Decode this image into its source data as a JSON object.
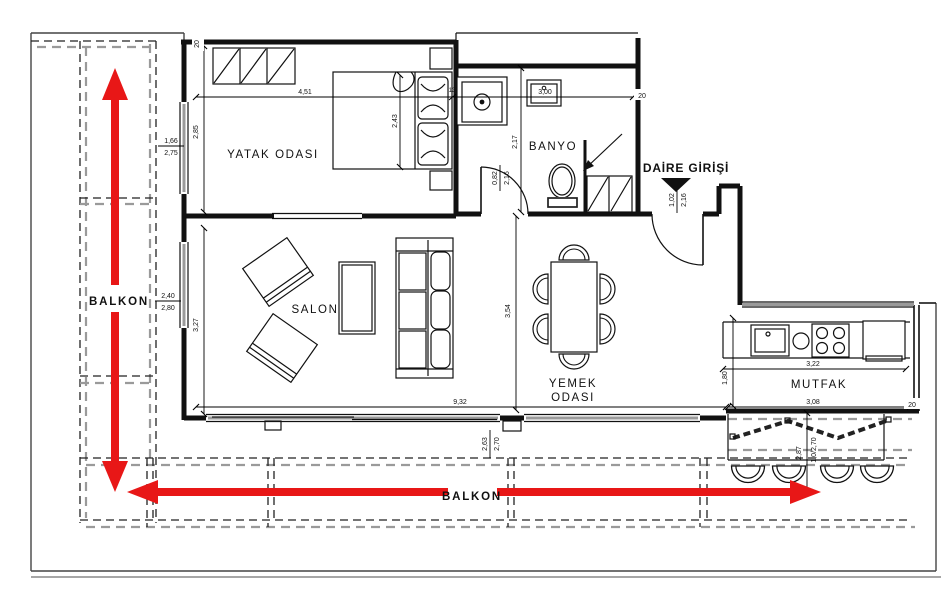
{
  "rooms": {
    "bedroom": "YATAK ODASI",
    "bathroom": "BANYO",
    "salon": "SALON",
    "dining_line1": "YEMEK",
    "dining_line2": "ODASI",
    "kitchen": "MUTFAK",
    "balcony_left": "BALKON",
    "balcony_bottom": "BALKON",
    "entrance": "DAİRE GİRİŞİ"
  },
  "dims": {
    "bedroom_width": "4,51",
    "wall13": "13",
    "bath_width": "3,00",
    "wall20_top": "20",
    "wall20_bath": "20",
    "wall20_kitchen": "20",
    "bed_depth": "2,43",
    "bedroom_height": "2,85",
    "bedroom_window_w": "1,66",
    "bedroom_window_h": "2,75",
    "salon_window_w": "2,40",
    "salon_window_h": "2,80",
    "salon_height": "3,27",
    "bottom_width": "9,32",
    "slider_w": "2,63",
    "slider_h": "2,70",
    "bath_height": "2,17",
    "bath_door_w": "0,82",
    "bath_door_h": "2,16",
    "entry_door_w": "1,02",
    "entry_door_h": "2,16",
    "dining_height": "3,54",
    "kitchen_opening": "1,80",
    "counter_width": "3,22",
    "kitchen_width": "3,08",
    "balcony_depth": "2,87",
    "fold_door": "1,0/2,70"
  },
  "colors": {
    "arrow_red": "#e81717",
    "wall_black": "#111111",
    "glass_gray": "#9a9a9a"
  }
}
